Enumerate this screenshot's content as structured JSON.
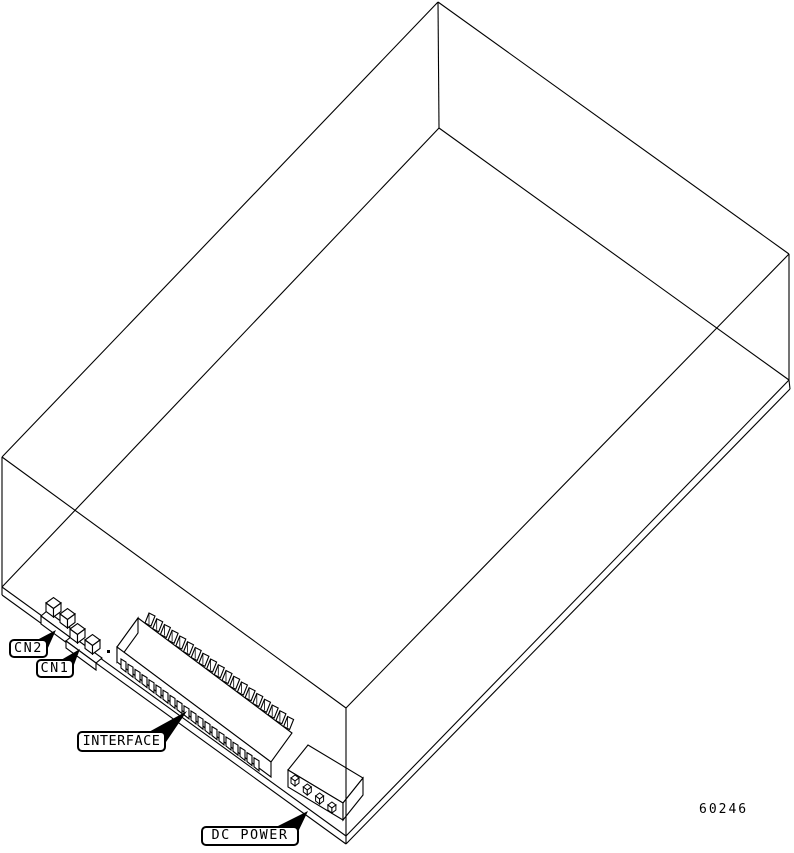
{
  "figure": {
    "number": "60246",
    "background": "#ffffff",
    "line_color": "#000000"
  },
  "callouts": {
    "cn2": {
      "label": "CN2"
    },
    "cn1": {
      "label": "CN1"
    },
    "interface": {
      "label": "INTERFACE"
    },
    "dc_power": {
      "label": "DC POWER"
    }
  }
}
